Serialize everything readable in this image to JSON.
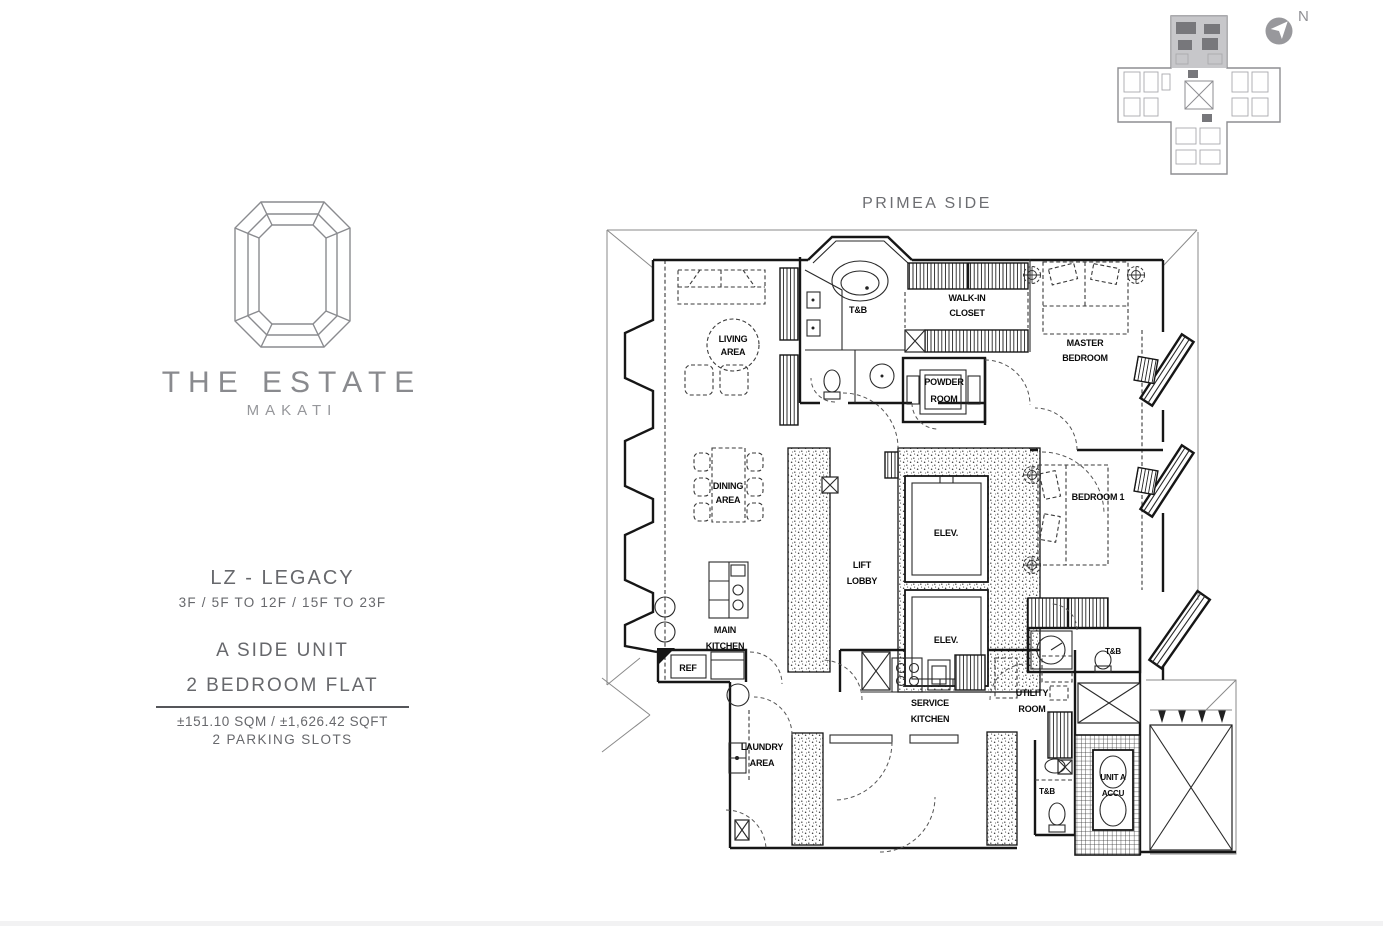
{
  "colors": {
    "ink": "#1a1a1a",
    "brand_gray": "#8a8b8f",
    "text_gray": "#67686c",
    "outer_line": "#8a8a8a",
    "keyplan_highlight": "#b9b9bd"
  },
  "brand": {
    "name": "THE ESTATE",
    "city": "MAKATI"
  },
  "compass": {
    "label": "N"
  },
  "unit_info": {
    "series": "LZ - LEGACY",
    "floors": "3F / 5F TO 12F / 15F TO 23F",
    "side": "A SIDE UNIT",
    "type": "2 BEDROOM FLAT",
    "area": "±151.10 SQM /  ±1,626.42 SQFT",
    "parking": "2 PARKING SLOTS"
  },
  "plan": {
    "orientation_label": "PRIMEA SIDE",
    "rooms": {
      "living": [
        "LIVING",
        "AREA"
      ],
      "dining": [
        "DINING",
        "AREA"
      ],
      "master_tb": "T&B",
      "closet": [
        "WALK-IN",
        "CLOSET"
      ],
      "master_bedroom": [
        "MASTER",
        "BEDROOM"
      ],
      "powder": [
        "POWDER",
        "ROOM"
      ],
      "lift_lobby": [
        "LIFT",
        "LOBBY"
      ],
      "elevator": "ELEV.",
      "bedroom1": "BEDROOM 1",
      "main_kitchen": [
        "MAIN",
        "KITCHEN"
      ],
      "ref": "REF",
      "bedroom1_tb": "T&B",
      "service_kitchen": [
        "SERVICE",
        "KITCHEN"
      ],
      "utility": [
        "UTILITY",
        "ROOM"
      ],
      "laundry": [
        "LAUNDRY",
        "AREA"
      ],
      "service_tb": "T&B",
      "accu": [
        "UNIT A",
        "ACCU"
      ]
    }
  }
}
